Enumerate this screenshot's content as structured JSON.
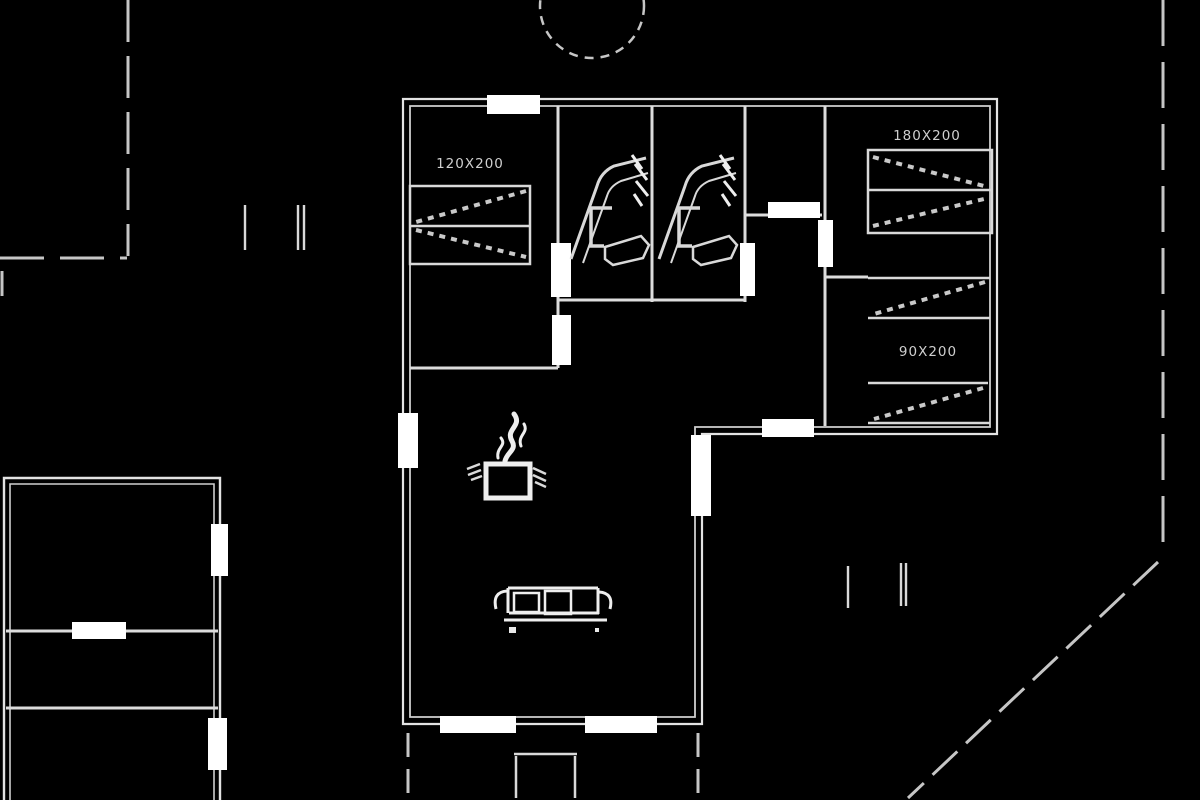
{
  "palette": {
    "background": "#000000",
    "wall_line": "#e3e3e3",
    "partition_line": "#dcdcdc",
    "fixture_line": "#d9d9d9",
    "hatch_line": "#c9c9c9",
    "boundary_dash": "#c6c6c6",
    "opening_fill": "#ffffff",
    "label_text": "#cfcfcf"
  },
  "labels": {
    "bed_left": "120X200",
    "bed_right_double": "180X200",
    "bed_right_single": "90X200"
  },
  "icons": {
    "tree-icon": "dashed-circle",
    "toilet-icon": "tank-and-bowl-outline",
    "sink-icon": "angled-vanity-outline",
    "fireplace-icon": "stove-box-with-flame",
    "sofa-icon": "three-seat-sofa-outline",
    "bed-icon": "hatched-rectangle",
    "boundary-icon": "dashed-property-line",
    "marker-icon": "short-tick-lines"
  }
}
